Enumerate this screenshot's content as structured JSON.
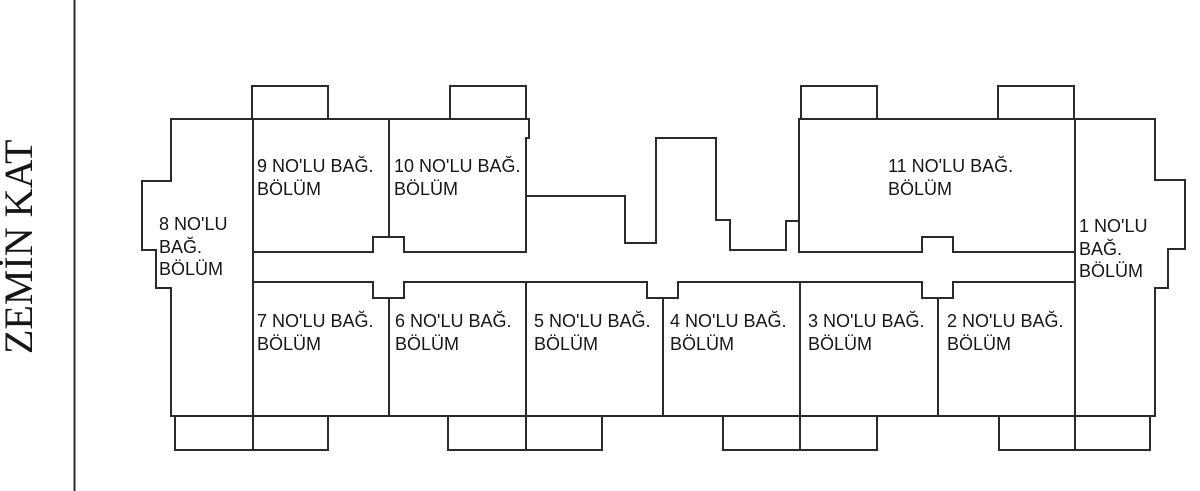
{
  "title": {
    "floor_label": "ZEMİN KAT"
  },
  "colors": {
    "background": "#ffffff",
    "line": "#2b2b2b",
    "text": "#161616"
  },
  "rooms": [
    {
      "id": "1",
      "label": "1 NO'LU\nBAĞ.\nBÖLÜM"
    },
    {
      "id": "2",
      "label": "2 NO'LU BAĞ.\nBÖLÜM"
    },
    {
      "id": "3",
      "label": "3 NO'LU BAĞ.\nBÖLÜM"
    },
    {
      "id": "4",
      "label": "4 NO'LU BAĞ.\nBÖLÜM"
    },
    {
      "id": "5",
      "label": "5 NO'LU BAĞ.\nBÖLÜM"
    },
    {
      "id": "6",
      "label": "6 NO'LU BAĞ.\nBÖLÜM"
    },
    {
      "id": "7",
      "label": "7 NO'LU BAĞ.\nBÖLÜM"
    },
    {
      "id": "8",
      "label": "8 NO'LU\nBAĞ.\nBÖLÜM"
    },
    {
      "id": "9",
      "label": "9 NO'LU BAĞ.\nBÖLÜM"
    },
    {
      "id": "10",
      "label": "10 NO'LU BAĞ.\nBÖLÜM"
    },
    {
      "id": "11",
      "label": "11 NO'LU BAĞ.\nBÖLÜM"
    }
  ]
}
